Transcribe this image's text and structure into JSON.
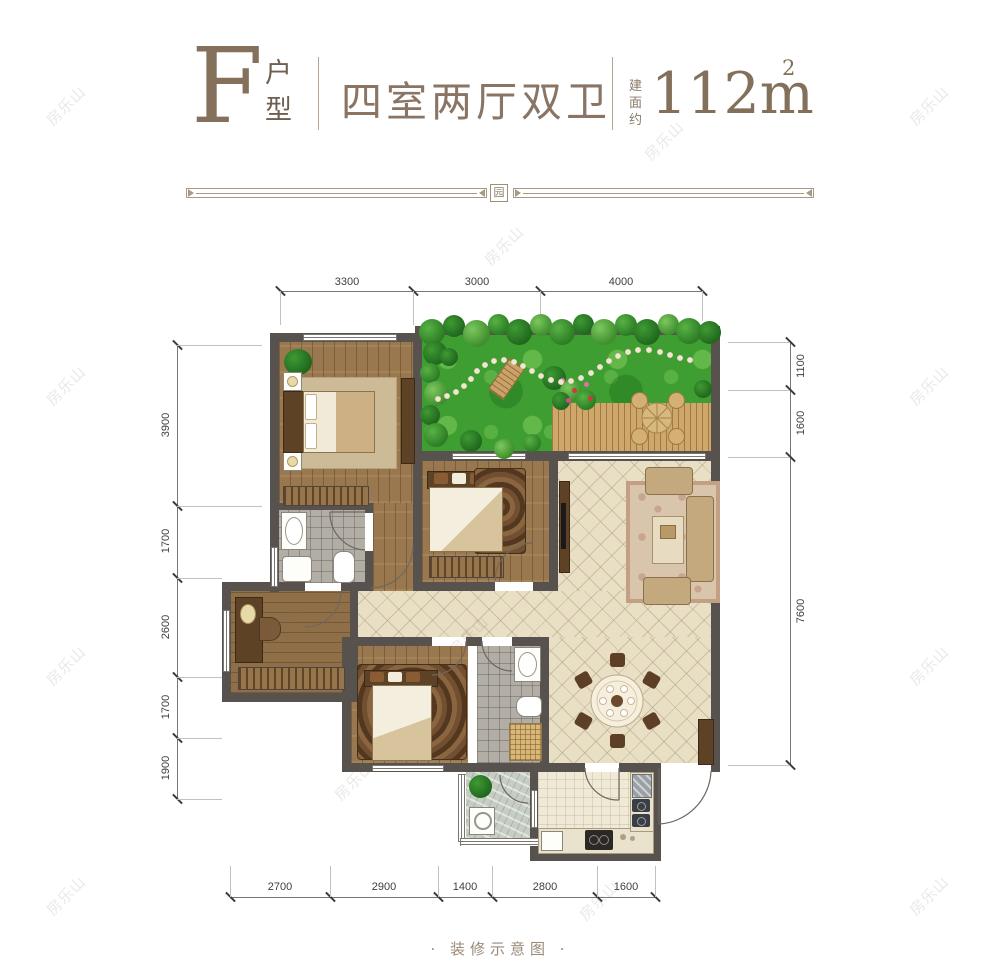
{
  "header": {
    "unit_letter": "F",
    "unit_type_chars": [
      "户",
      "型"
    ],
    "title": "四室两厅双卫",
    "area_label_chars": [
      "建",
      "面",
      "约"
    ],
    "area_value": "112m",
    "area_sup": "2"
  },
  "ornament": {
    "badge": "园"
  },
  "dimensions": {
    "top": [
      "3300",
      "3000",
      "4000"
    ],
    "left": [
      "3900",
      "1700",
      "2600",
      "1700",
      "1900"
    ],
    "right": [
      "1100",
      "1600",
      "7600"
    ],
    "bottom": [
      "2700",
      "2900",
      "1400",
      "2800",
      "1600"
    ]
  },
  "footer": {
    "caption": "· 装修示意图 ·"
  },
  "watermark": {
    "text": "房乐山"
  },
  "colors": {
    "accent_brown": "#8a7160",
    "wall": "#57524d",
    "wood_floor": "#9a784f",
    "tile_floor": "#e9dfc5",
    "grass": "#3f9e31",
    "deck": "#cfa76b",
    "dimension_text": "#3f3f3f",
    "watermark": "#cfc9c0"
  }
}
